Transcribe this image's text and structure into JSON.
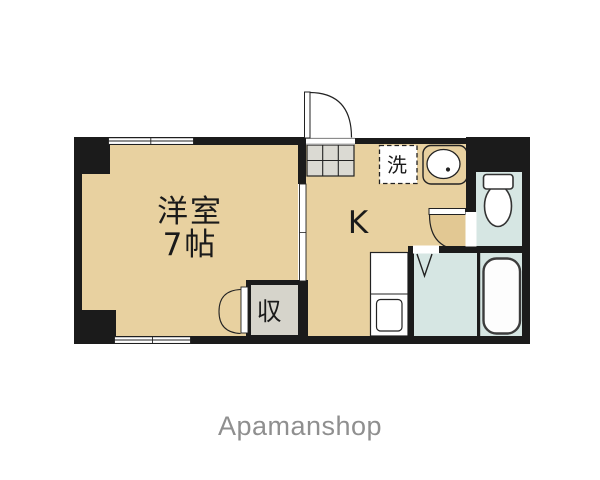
{
  "plan": {
    "title": "1K apartment floor plan",
    "rooms": {
      "western_room": {
        "name": "洋室",
        "size": "7帖"
      },
      "kitchen": {
        "label": "K"
      },
      "closet": {
        "label": "収"
      },
      "washer_space": {
        "label": "洗"
      }
    },
    "colors": {
      "floor_tan": "#e8d1a0",
      "door_tan": "#e2c893",
      "wet_area_blue": "#d6e6e3",
      "closet_gray": "#d6d4cb",
      "cabinet_gray": "#dbdad3",
      "wall_black": "#1b1b1b",
      "line_dark": "#222222"
    },
    "fixtures": [
      "entrance-door",
      "shoe-cabinet",
      "washing-machine-space",
      "kitchen-sink",
      "stove",
      "kitchen-counter",
      "toilet",
      "bathtub",
      "folding-bath-door",
      "closet-double-doors",
      "sliding-door",
      "window"
    ]
  },
  "footer": {
    "brand": "Apamanshop",
    "color": "#8f8f8f"
  }
}
